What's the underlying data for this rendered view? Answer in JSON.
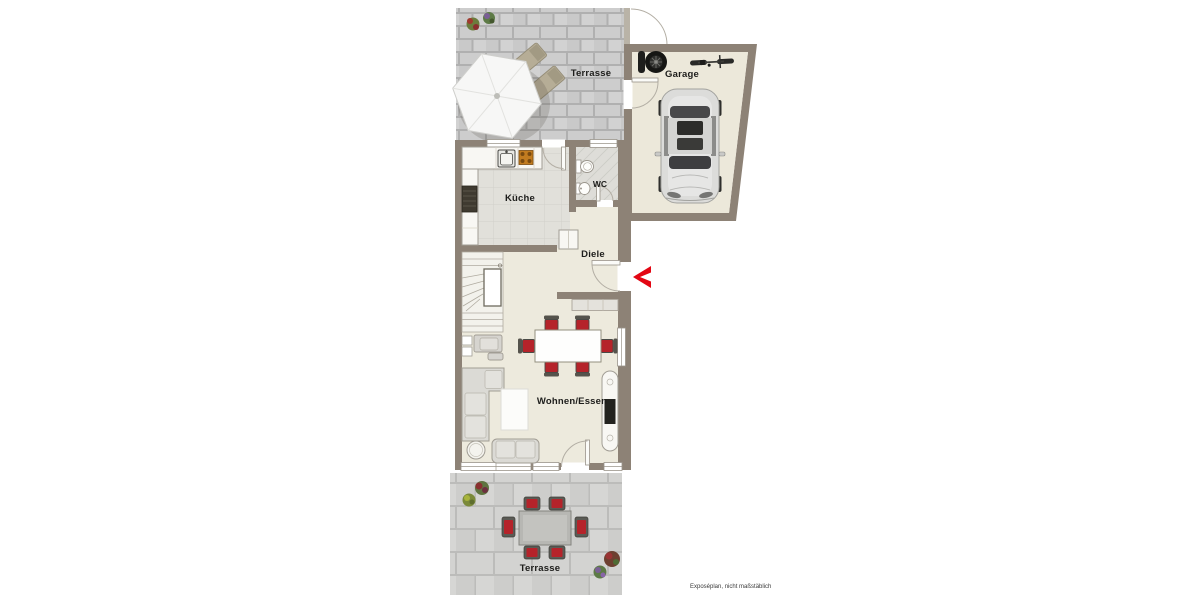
{
  "plan": {
    "type": "floorplan",
    "footnote": "Exposéplan, nicht maßstäblich",
    "rooms": {
      "terrace_top": "Terrasse",
      "garage": "Garage",
      "kitchen": "Küche",
      "wc": "WC",
      "hallway": "Diele",
      "living_dining": "Wohnen/Essen",
      "terrace_bottom": "Terrasse"
    },
    "icons": {
      "parasol": "parasol",
      "sun_lounger": "sun lounger",
      "car": "car top view",
      "bicycle": "bicycle",
      "tires": "tire stack",
      "entrance_arrow": "entrance chevron",
      "plants": "flower pots"
    },
    "colors": {
      "wall": "#8d8276",
      "floor": "#edeadd",
      "garage_floor": "#ece8da",
      "paving_light": "#d3d3d1",
      "paving_dark": "#c9c9c9",
      "accent_red": "#e30613",
      "chair_red": "#b5232a",
      "label_text": "#1d1d1b"
    }
  }
}
